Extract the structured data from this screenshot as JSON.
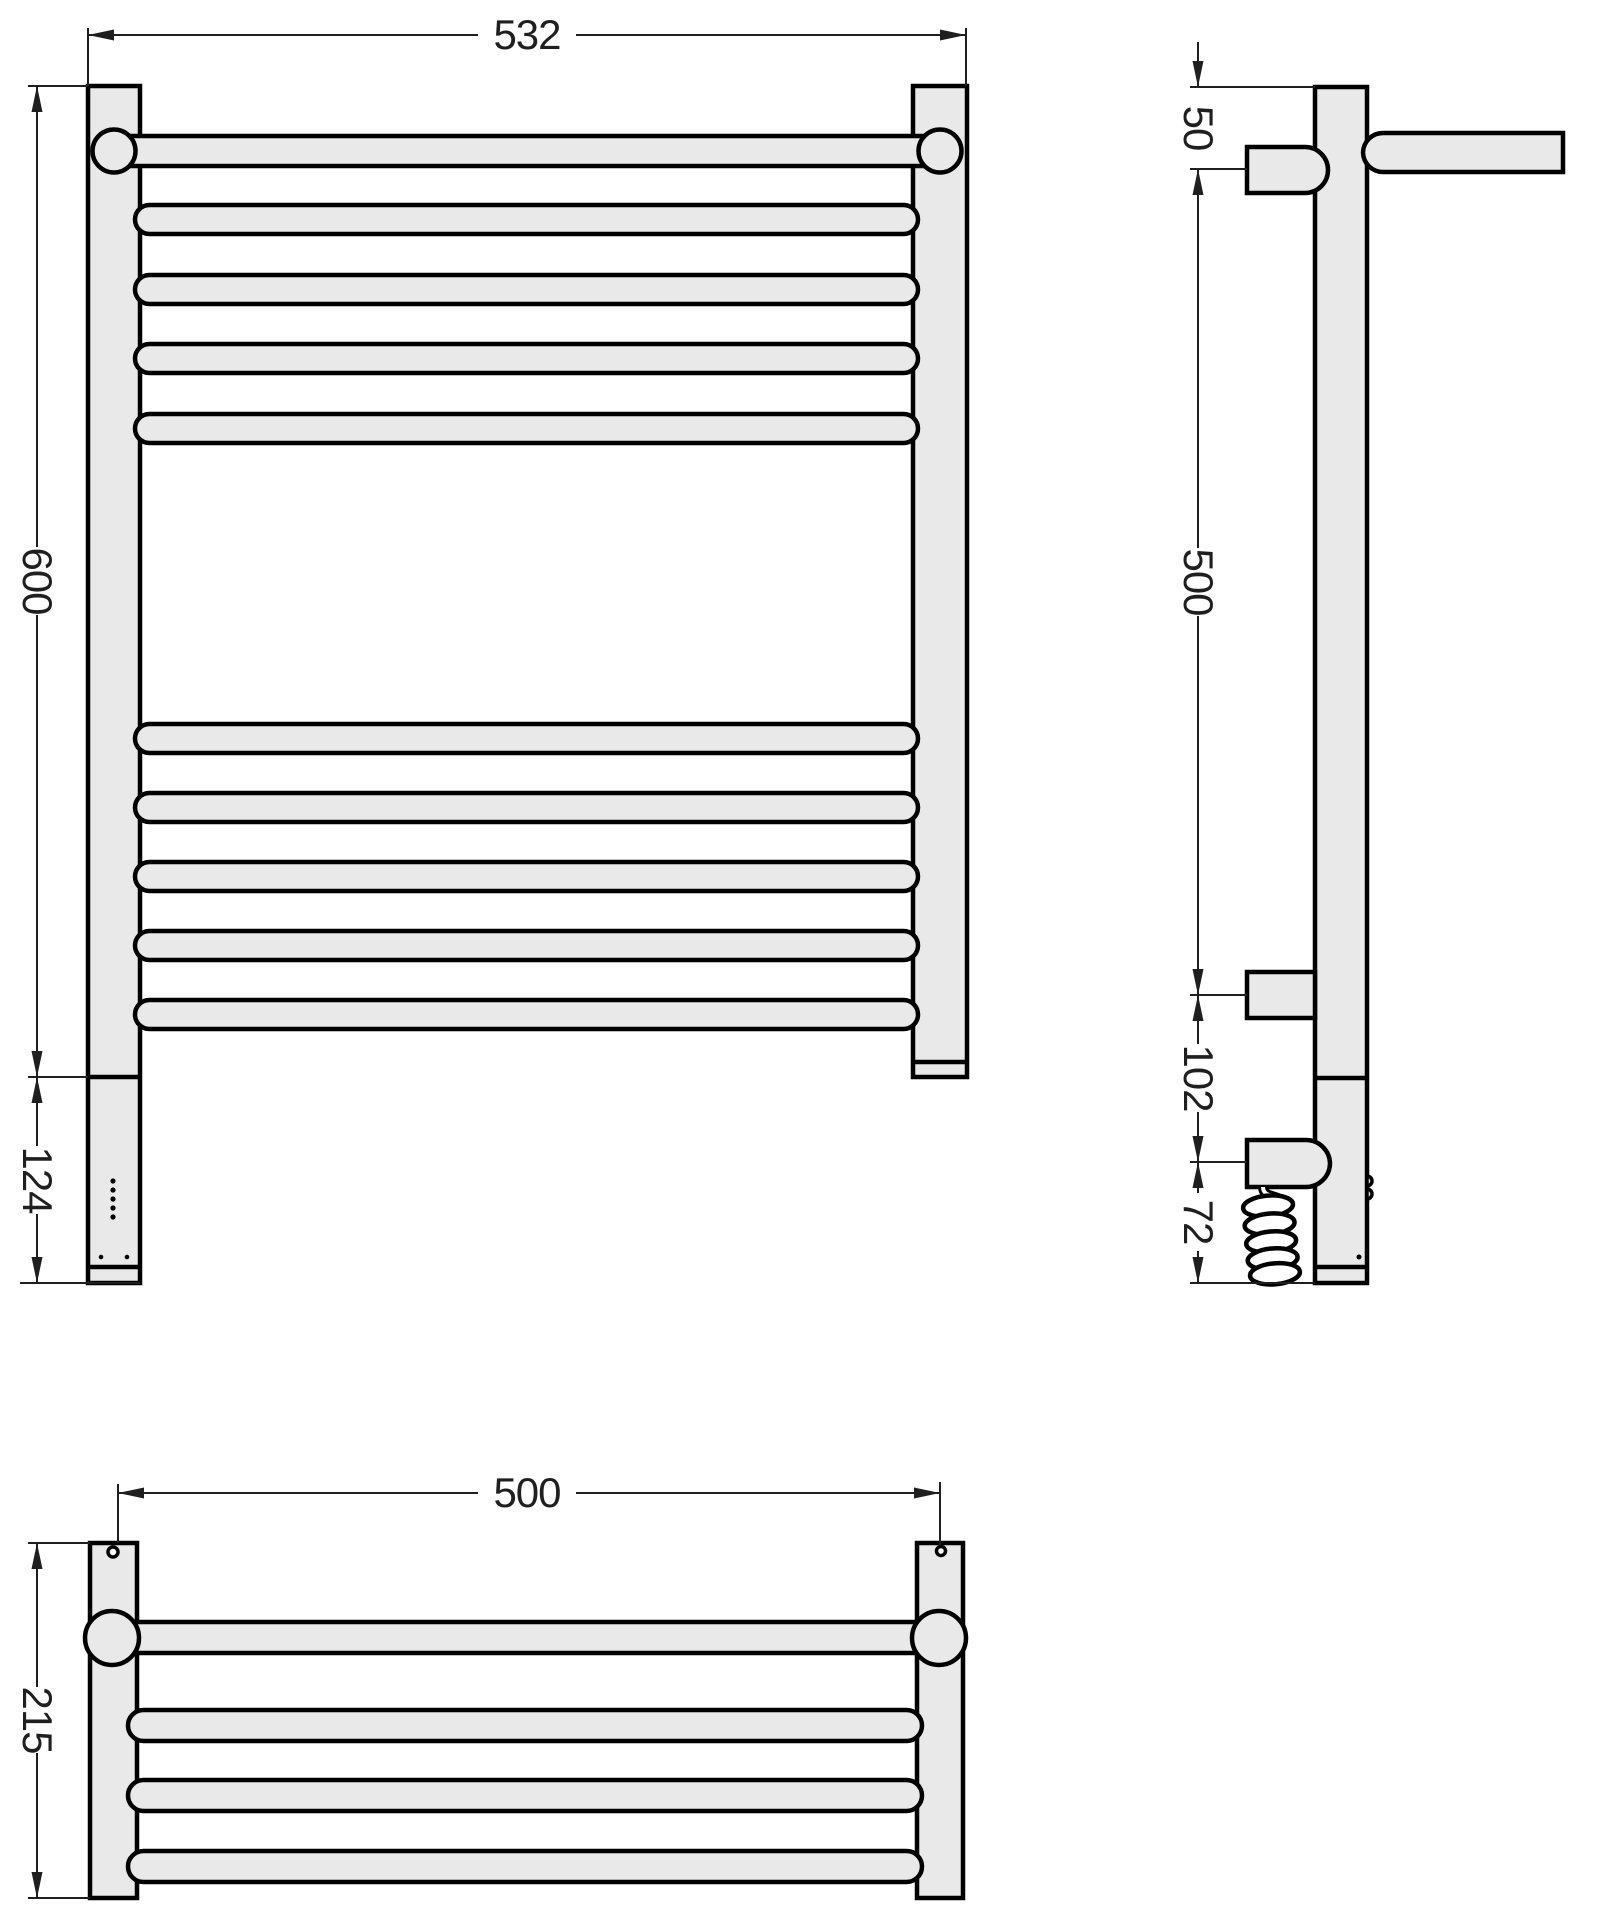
{
  "colors": {
    "background": "#ffffff",
    "metal": "#e9e9e9",
    "outline": "#000000",
    "dimension": "#1f1f1f"
  },
  "views": {
    "front": {
      "dims": {
        "width": "532",
        "height": "600",
        "electrical_section": "124"
      }
    },
    "side": {
      "dims": {
        "top_bracket_offset": "50",
        "bracket_spacing": "500",
        "bracket_to_outlet": "102",
        "outlet_to_end": "72"
      }
    },
    "bottom": {
      "dims": {
        "mounting_width": "500",
        "depth": "215"
      }
    }
  }
}
